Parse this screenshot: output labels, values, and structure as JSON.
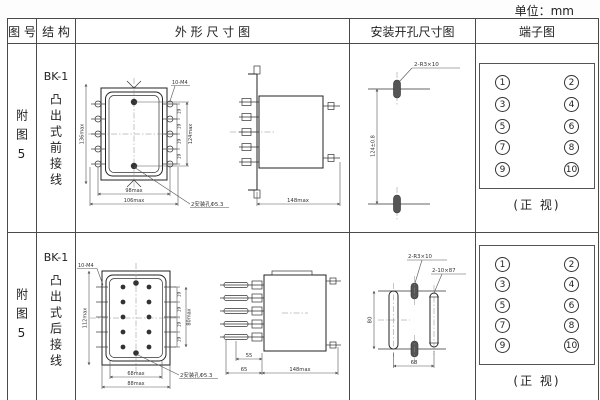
{
  "unit_label": "单位：mm",
  "headers": {
    "figure": "图 号",
    "structure": "结 构",
    "outline": "外  形  尺  寸  图",
    "mounting": "安装开孔尺寸图",
    "terminal": "端子图"
  },
  "rows": [
    {
      "figure_no": "附图5",
      "model": "BK-1",
      "structure": "凸出式前接线",
      "outline": {
        "dim_left": "136max",
        "dim_right": "124max",
        "thread": "10-M4",
        "pitch": "19",
        "dim_w1": "98max",
        "dim_w2": "106max",
        "holes": "2安装孔Φ5.3",
        "side_w": "148max"
      },
      "mounting": {
        "dim_v": "124±0.8",
        "slot": "2-R3×10"
      },
      "terminal": {
        "left": [
          "1",
          "3",
          "5",
          "7",
          "9"
        ],
        "right": [
          "2",
          "4",
          "6",
          "8",
          "10"
        ],
        "caption": "(正 视)"
      }
    },
    {
      "figure_no": "附图5",
      "model": "BK-1",
      "structure": "凸出式后接线",
      "outline": {
        "thread": "10-M4",
        "dim_left": "112max",
        "dim_right": "80max",
        "pitch": "19",
        "dim_w1": "68max",
        "dim_w2": "88max",
        "holes": "2安装孔Φ5.3",
        "pin_a": "55",
        "pin_b": "65",
        "side_w": "148max"
      },
      "mounting": {
        "slot": "2-R3×10",
        "slot2": "2-10×87",
        "dim_v": "80",
        "dim_w": "68"
      },
      "terminal": {
        "left": [
          "1",
          "3",
          "5",
          "7",
          "9"
        ],
        "right": [
          "2",
          "4",
          "6",
          "8",
          "10"
        ],
        "caption": "(正 视)"
      }
    }
  ]
}
